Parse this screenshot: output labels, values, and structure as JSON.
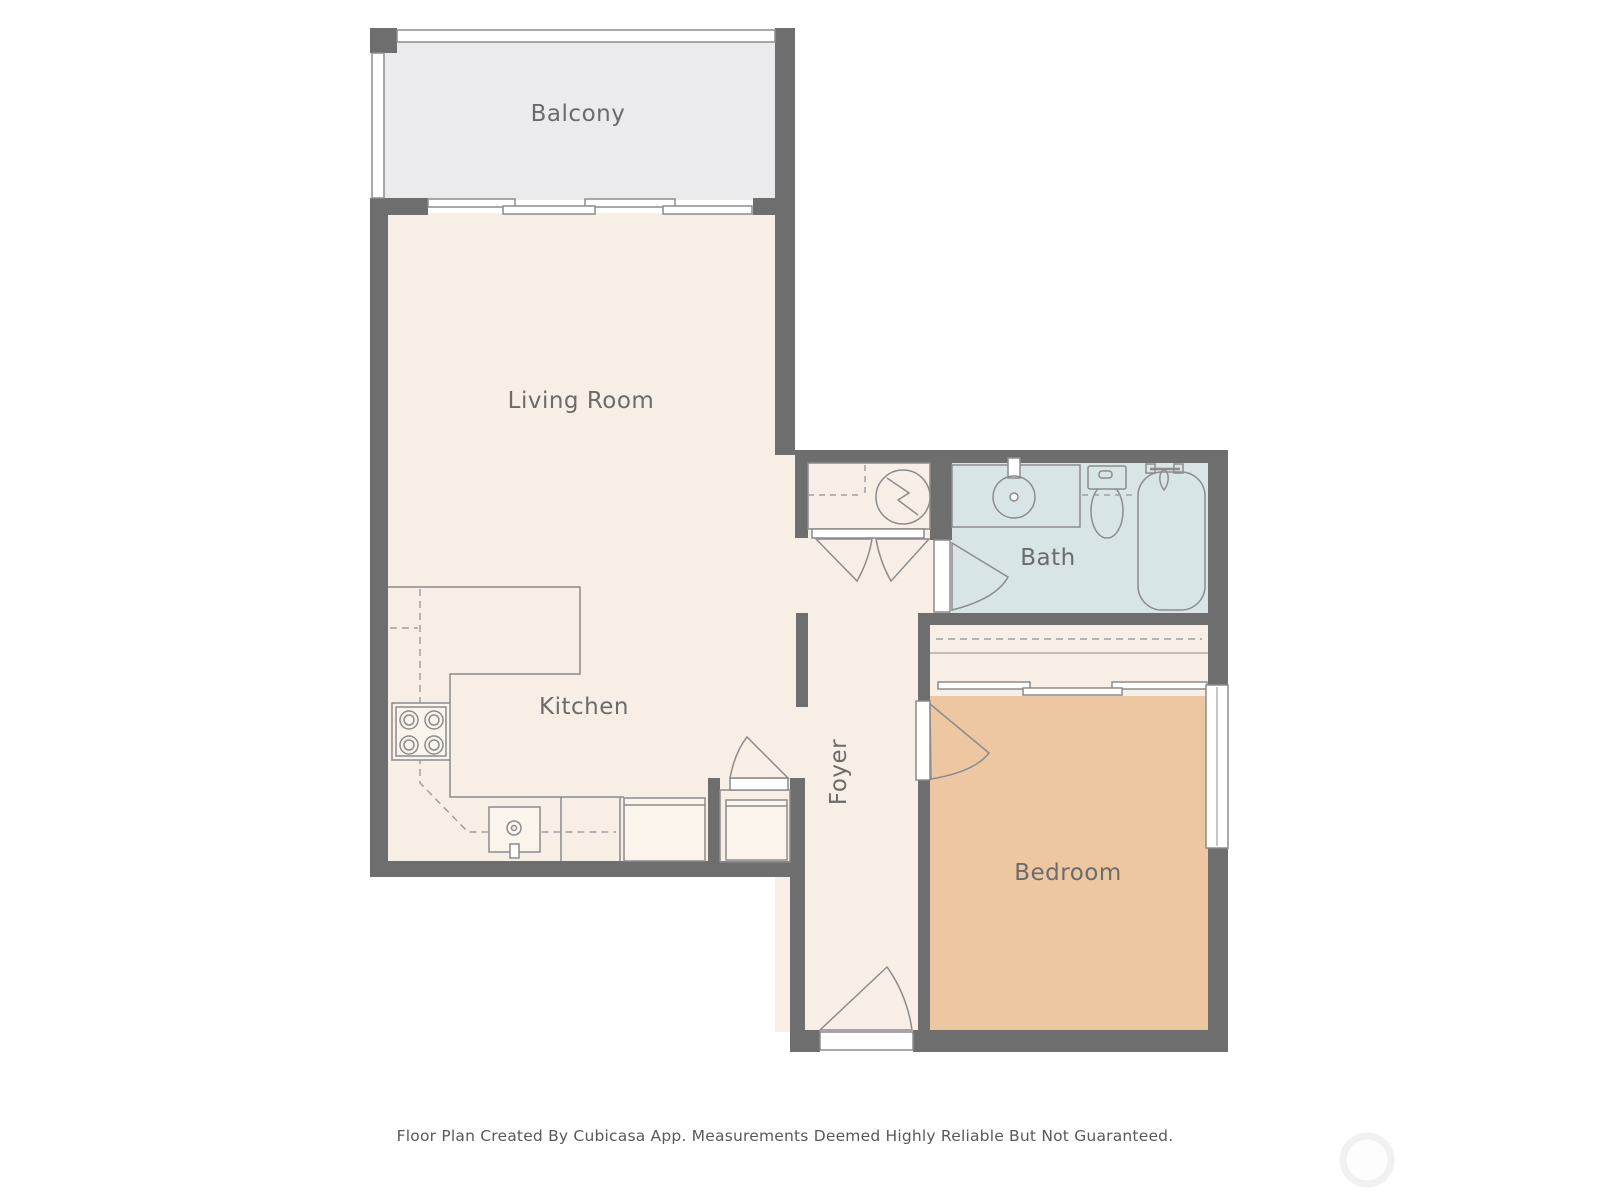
{
  "footer": {
    "disclaimer": "Floor Plan Created By Cubicasa App. Measurements Deemed Highly Reliable But Not Guaranteed."
  },
  "rooms": {
    "balcony": {
      "label": "Balcony"
    },
    "living_room": {
      "label": "Living Room"
    },
    "kitchen": {
      "label": "Kitchen"
    },
    "foyer": {
      "label": "Foyer"
    },
    "bath": {
      "label": "Bath"
    },
    "bedroom": {
      "label": "Bedroom"
    }
  },
  "fixtures": {
    "kitchen": [
      "stove-cooktop",
      "kitchen-sink",
      "refrigerator",
      "upper-cabinet-dashed-outline"
    ],
    "bath": [
      "vanity-sink",
      "toilet",
      "bathtub",
      "shower-fixture"
    ],
    "utility": [
      "water-heater"
    ],
    "pantry": [
      "washer-appliance"
    ],
    "doors": [
      "balcony-sliding-door",
      "bedroom-closet-sliding-door",
      "entry-door",
      "bedroom-door",
      "bath-door",
      "utility-double-doors",
      "pantry-door"
    ],
    "windows": [
      "bedroom-window",
      "balcony-railing"
    ]
  },
  "colors": {
    "wall": "#6e6e6e",
    "interior_floor": "#f7efe6",
    "balcony_floor": "#ebebed",
    "bath_floor": "#d7e5e6",
    "bedroom_floor": "#ecc7a2",
    "fixture_outline": "#8c8c8c",
    "dashed_line": "#a0a0a0",
    "label_text": "#6b6b6b",
    "footer_text": "#58595b",
    "watermark": "#f1f1f1"
  }
}
